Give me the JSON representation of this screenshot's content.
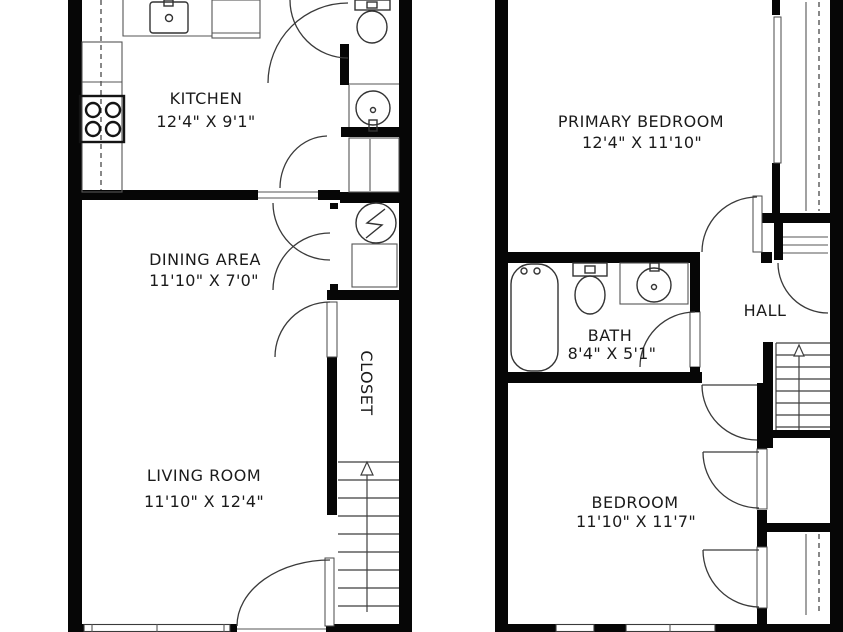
{
  "plan": {
    "floors": [
      {
        "id": "first-floor",
        "rooms": [
          {
            "name": "KITCHEN",
            "dims": "12'4\" X 9'1\""
          },
          {
            "name": "DINING AREA",
            "dims": "11'10\" X 7'0\""
          },
          {
            "name": "LIVING ROOM",
            "dims": "11'10\" X 12'4\""
          }
        ],
        "labels": {
          "closet": "CLOSET"
        }
      },
      {
        "id": "second-floor",
        "rooms": [
          {
            "name": "PRIMARY BEDROOM",
            "dims": "12'4\" X 11'10\""
          },
          {
            "name": "BATH",
            "dims": "8'4\" X 5'1\""
          },
          {
            "name": "BEDROOM",
            "dims": "11'10\" X 11'7\""
          }
        ],
        "labels": {
          "hall": "HALL"
        }
      }
    ],
    "colors": {
      "wall": "#060606",
      "line": "#3a3a3a",
      "text": "#1b1b1b",
      "background": "#ffffff"
    }
  }
}
